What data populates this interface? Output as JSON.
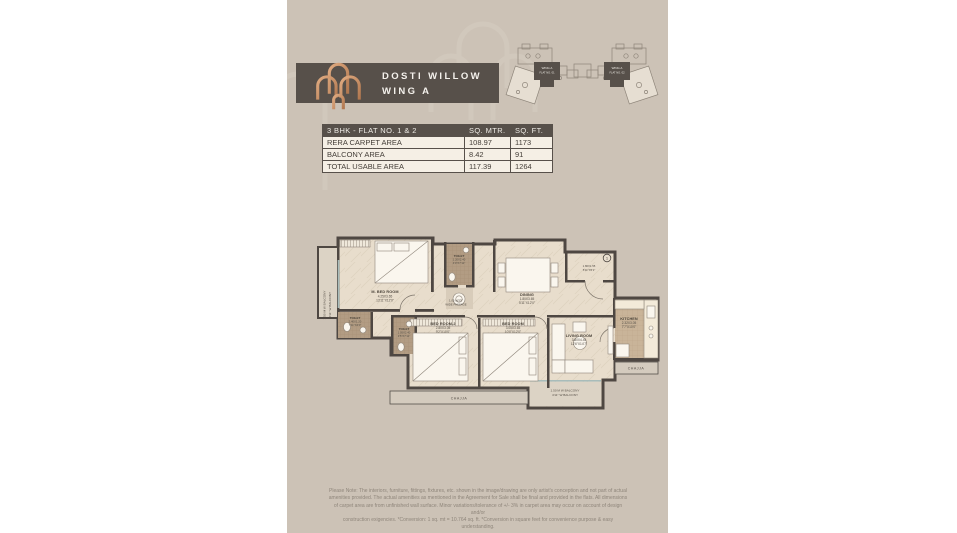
{
  "colors": {
    "panel_bg": "#ccc2b6",
    "header_bar": "#57504a",
    "logo_copper": "#c08a66",
    "table_header_bg": "#57504a",
    "table_body_bg": "#f5efe5",
    "plan_walls": "#4e4742",
    "plan_floor": "#e8ddcc",
    "toilet_floor": "#b29c83"
  },
  "header": {
    "title_line1": "DOSTI WILLOW",
    "title_line2": "WING A"
  },
  "key_plan": {
    "wing_label": "WING A",
    "flat1_label": "FLAT NO. 01",
    "flat2_label": "FLAT NO. 02"
  },
  "table": {
    "headers": [
      "3 BHK - FLAT NO. 1 & 2",
      "SQ. MTR.",
      "SQ. FT."
    ],
    "rows": [
      {
        "label": "RERA CARPET AREA",
        "sq_mtr": "108.97",
        "sq_ft": "1173"
      },
      {
        "label": "BALCONY AREA",
        "sq_mtr": "8.42",
        "sq_ft": "91"
      },
      {
        "label": "TOTAL USABLE AREA",
        "sq_mtr": "117.39",
        "sq_ft": "1264"
      }
    ]
  },
  "plan": {
    "rooms": [
      {
        "name": "M. BED ROOM",
        "m": "4.25X3.65",
        "ft": "13'11\"X12'0\""
      },
      {
        "name": "BED ROOM-2",
        "m": "2.80X3.05",
        "ft": "9'2\"X10'0\""
      },
      {
        "name": "BED ROOM",
        "m": "3.05X3.65",
        "ft": "10'0\"X12'0\""
      },
      {
        "name": "LIVING ROOM",
        "m": "3.80X4.45",
        "ft": "12'6\"X14'7\""
      },
      {
        "name": "DINING",
        "m": "1.80X3.65",
        "ft": "5'11\"X12'0\""
      },
      {
        "name": "KITCHEN",
        "m": "2.32X3.05",
        "ft": "7'7\"X10'0\""
      },
      {
        "name": "TOILET",
        "m": "2.40X1.20",
        "ft": "7'11\"X4'0\""
      },
      {
        "name": "TOILET",
        "m": "1.05X2.40",
        "ft": "3'5\"X7'11\""
      },
      {
        "name": "TOILET",
        "m": "1.20X2.40",
        "ft": "4'0\"X7'11\""
      }
    ],
    "passage": {
      "line1": "1.05 M/3'5\"",
      "line2": "WIDE PASSAGE"
    },
    "entry": {
      "marker": "1",
      "m": "1.80X1.55",
      "ft": "5'11\"X5'1\""
    },
    "balcony_left": {
      "line1": "1.50 M W BALCONY",
      "line2": "4'11\" W BALCONY"
    },
    "balcony_bottom": {
      "line1": "1.50 M W BALCONY",
      "line2": "4'11\" W BALCONY"
    },
    "chajja_right": "CHAJJA",
    "chajja_bottom": "CHAJJA"
  },
  "disclaimer": {
    "lines": [
      "Please Note: The interiors, furniture, fittings, fixtures, etc. shown in the image/drawing are only artist's conception and not part of actual",
      "amenities provided. The actual amenities as mentioned in the Agreement for Sale shall be final and provided in the flats. All dimensions",
      "of carpet area are from unfinished wall surface. Minor variations/tolerance of +/- 3% in carpet area may occur on account of design and/or",
      "construction exigencies. *Conversion: 1 sq. mt = 10.764 sq. ft. *Conversion in square feet for convenience purpose & easy understanding."
    ]
  }
}
